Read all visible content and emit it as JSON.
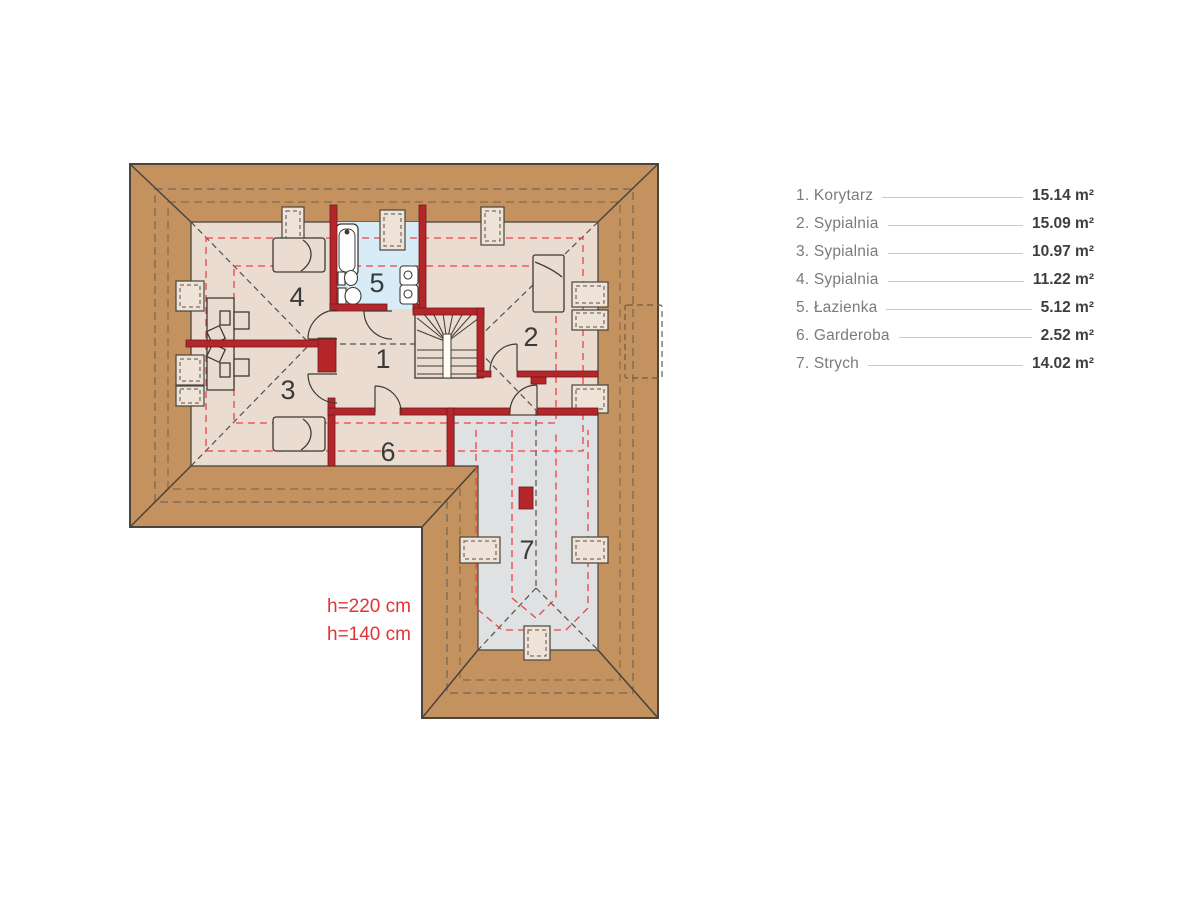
{
  "plan": {
    "room_numbers": [
      "1",
      "2",
      "3",
      "4",
      "5",
      "6",
      "7"
    ],
    "height_labels": [
      "h=220 cm",
      "h=140 cm"
    ],
    "colors": {
      "roof": "#C4925F",
      "floor": "#EADCD1",
      "attic_floor": "#DFE1E3",
      "bathroom_floor": "#D8ECF8",
      "walls": "#B5262B",
      "height_lines": "#EF4143",
      "outline": "#4A443C",
      "room_label_text": "#3A3A3A",
      "height_label_text": "#E23434"
    }
  },
  "legend": {
    "items": [
      {
        "label": "1. Korytarz",
        "area": "15.14 m²"
      },
      {
        "label": "2. Sypialnia",
        "area": "15.09 m²"
      },
      {
        "label": "3. Sypialnia",
        "area": "10.97 m²"
      },
      {
        "label": "4. Sypialnia",
        "area": "11.22 m²"
      },
      {
        "label": "5. Łazienka",
        "area": "5.12 m²"
      },
      {
        "label": "6. Garderoba",
        "area": "2.52 m²"
      },
      {
        "label": "7. Strych",
        "area": "14.02 m²"
      }
    ]
  }
}
